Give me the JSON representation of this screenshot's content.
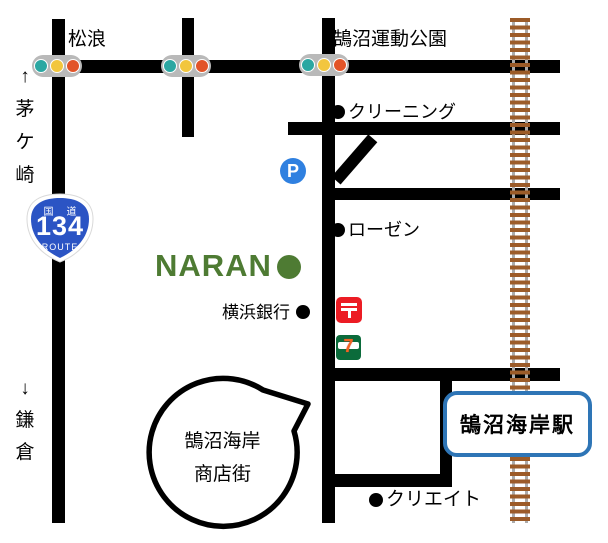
{
  "labels": {
    "matsunami": "松浪",
    "sports_park": "鵠沼運動公園",
    "cleaning": "クリーニング",
    "rosen": "ローゼン",
    "yokohama_bank": "横浜銀行",
    "create": "クリエイト",
    "chigasaki_direction": "↑\n茅\nケ\n崎",
    "kamakura_direction": "↓\n鎌\n倉"
  },
  "naran": {
    "name": "NARAN"
  },
  "route_sign": {
    "kokudo_left": "国",
    "kokudo_right": "道",
    "number": "134",
    "route_word": "ROUTE"
  },
  "station": {
    "name": "鵠沼海岸駅"
  },
  "bubble": {
    "line1": "鵠沼海岸",
    "line2": "商店街"
  },
  "icons": {
    "parking_letter": "P",
    "seven_number": "7",
    "post_mark": "〒"
  },
  "colors": {
    "road_black": "#000000",
    "traffic_light_body": "#b9b9b9",
    "traffic_light_teal": "#2ba7a2",
    "traffic_light_yellow": "#f2c63e",
    "traffic_light_red": "#e25428",
    "railway_tie_brown": "#9c5b28",
    "railway_rail_gray": "#ababab",
    "route_sign_blue": "#2b54c4",
    "parking_blue": "#2f80e0",
    "post_red": "#ec1c24",
    "seven_green": "#0b6b3b",
    "seven_orange": "#f26522",
    "naran_green": "#4e7b33",
    "station_border_blue": "#2e75b6"
  }
}
